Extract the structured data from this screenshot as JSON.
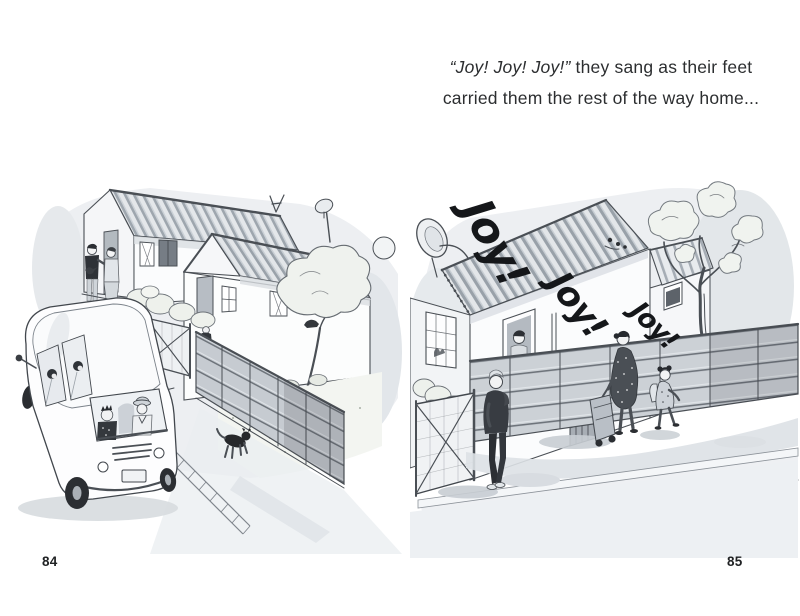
{
  "page": {
    "background": "#ffffff",
    "left_number": "84",
    "right_number": "85"
  },
  "caption": {
    "line1_italic": "“Joy! Joy! Joy!”",
    "line1_rest": " they sang as their feet",
    "line2": "carried them the rest of the way home..."
  },
  "illustrations": {
    "left": {
      "alt": "Minibus taxi full of passengers driving down a street past two small corrugated-roof houses with fenced yards, shrubs, a tree, two people chatting at a gate and a black dog crossing the road"
    },
    "right": {
      "alt": "Mother pulling a shopping trolley and a little girl walk home along a plank fence past a corrugated-roof house while a woman watches from a window; handwritten Joy! Joy! Joy! floats in the air above the roof",
      "joy_words": [
        "Joy!",
        "Joy!",
        "Joy!"
      ]
    }
  },
  "colors": {
    "ink": "#4a4f55",
    "wash_light": "#edeff2",
    "wash_mid": "#d9dde1",
    "dark": "#26282b"
  }
}
